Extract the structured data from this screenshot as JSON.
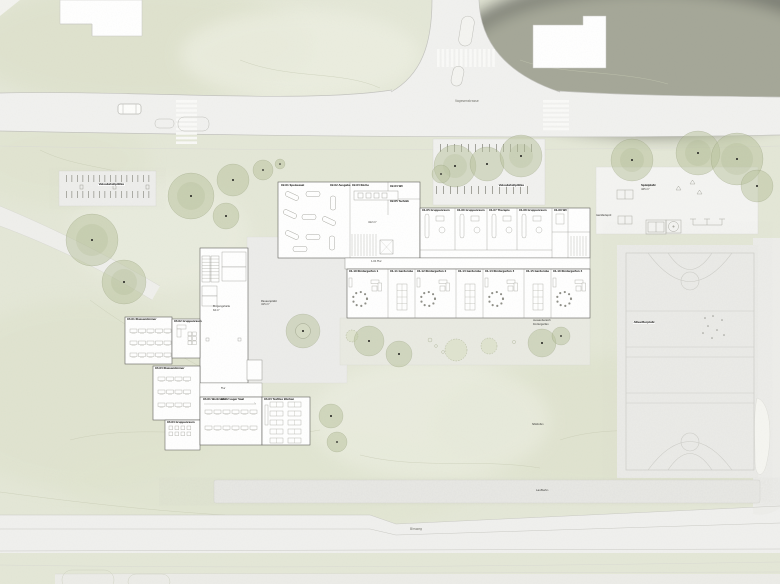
{
  "plan_type": "architectural site plan",
  "colors": {
    "grass": "#e4e7d7",
    "road": "#f0f0ee",
    "hard_surface": "#ececea",
    "building": "#ffffff",
    "building_outline": "#5f5f5a",
    "tree": "#b7c29c",
    "court": "#ebebe8",
    "edge_line": "#c6c6c2"
  },
  "labels": {
    "street_top": "Vogesenstrasse",
    "street_bottom": "Birsweg",
    "track": "Laufbahn",
    "court": "Allwetterplatz",
    "playground_title": "Spielplatz",
    "playground_area": "425 m²",
    "equipment_depot": "Gerätedepot",
    "bike_parking_center": "Veloabstellplätze",
    "bike_parking_west": "Veloabstellplätze",
    "plaza_title": "Pausenplatz",
    "plaza_area": "415 m²",
    "hall_title": "Eingangshalle",
    "hall_area": "62 m²",
    "hall_center": "412 m²",
    "corridor_main": "1.01 Flur",
    "corridor_west": "Flur",
    "garden_line1": "Aussenbereich",
    "garden_line2": "Kindergarten",
    "seat_steps": "Sitzstufen"
  },
  "rooms": [
    {
      "label": "02.01 Speisesaal"
    },
    {
      "label": "02.02 Ausgabe"
    },
    {
      "label": "02.03 Küche"
    },
    {
      "label": "02.04 WC"
    },
    {
      "label": "02.05 Technik"
    },
    {
      "label": "01.05 Gruppenraum"
    },
    {
      "label": "01.06 Gruppenraum"
    },
    {
      "label": "01.07 Therapie"
    },
    {
      "label": "01.08 Gruppenraum"
    },
    {
      "label": "01.09 WC"
    },
    {
      "label": "01.10 Kindergarten 1"
    },
    {
      "label": "01.11 Garderobe"
    },
    {
      "label": "01.12 Kindergarten 2"
    },
    {
      "label": "01.13 Garderobe"
    },
    {
      "label": "01.14 Kindergarten 3"
    },
    {
      "label": "01.15 Garderobe"
    },
    {
      "label": "01.16 Kindergarten 4"
    },
    {
      "label": "03.01 Klassenzimmer"
    },
    {
      "label": "03.02 Gruppenraum"
    },
    {
      "label": "03.03 Klassenzimmer"
    },
    {
      "label": "03.04 Gruppenraum"
    },
    {
      "label": "04.01 Werkraum"
    },
    {
      "label": "04.02 Lager Saal"
    },
    {
      "label": "04.03 Textiles Werken"
    }
  ]
}
